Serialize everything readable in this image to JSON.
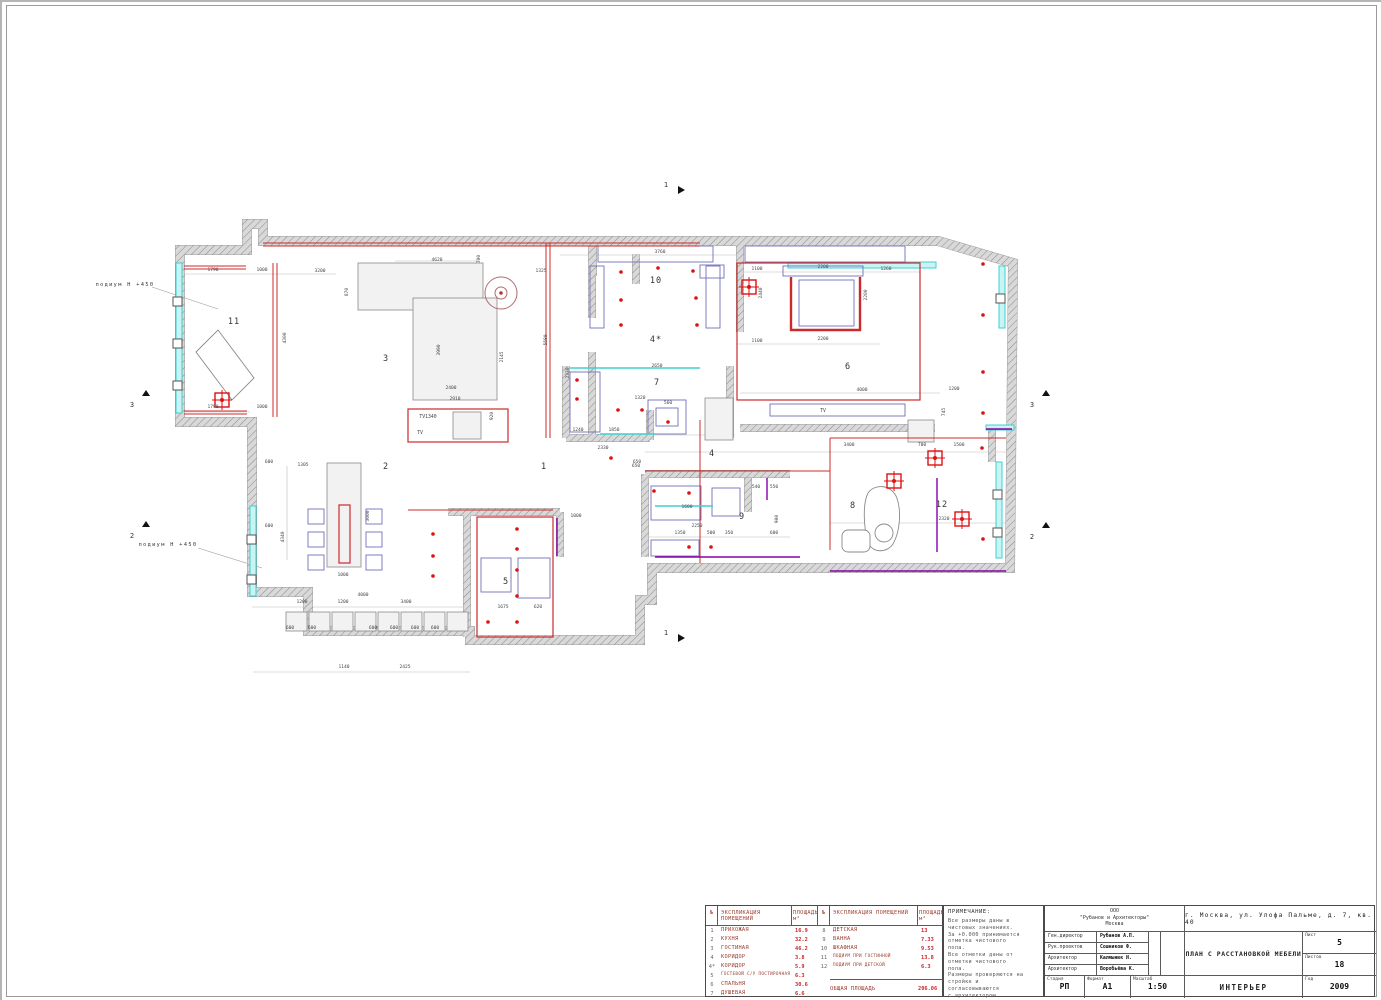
{
  "plan": {
    "wall_path": "M247,224 L263,224 L263,241 L938,241 L1013,263 L1010,568 L652,568 L652,600 L640,600 L640,640 L470,640 L470,631 L308,631 L308,592 L252,592 L252,422 L180,422 L180,250 L247,250 Z",
    "wallSeg": [
      [
        592,
        241,
        592,
        318
      ],
      [
        592,
        352,
        592,
        438
      ],
      [
        566,
        366,
        566,
        438
      ],
      [
        566,
        438,
        650,
        438
      ],
      [
        650,
        410,
        650,
        440
      ],
      [
        730,
        366,
        730,
        438
      ],
      [
        740,
        241,
        740,
        332
      ],
      [
        740,
        428,
        935,
        428
      ],
      [
        645,
        474,
        790,
        474
      ],
      [
        645,
        474,
        645,
        557
      ],
      [
        748,
        478,
        748,
        512
      ],
      [
        467,
        512,
        467,
        637
      ],
      [
        448,
        512,
        560,
        512
      ],
      [
        560,
        512,
        560,
        557
      ],
      [
        636,
        254,
        636,
        284
      ],
      [
        593,
        244,
        593,
        276
      ],
      [
        992,
        430,
        992,
        462
      ]
    ],
    "glaze": [
      [
        176,
        263,
        6,
        150
      ],
      [
        250,
        506,
        6,
        90
      ],
      [
        999,
        266,
        6,
        62
      ],
      [
        996,
        462,
        6,
        96
      ],
      [
        788,
        262,
        148,
        6
      ],
      [
        986,
        425,
        28,
        5
      ]
    ],
    "cols": [
      [
        173,
        297
      ],
      [
        173,
        339
      ],
      [
        173,
        381
      ],
      [
        247,
        535
      ],
      [
        247,
        575
      ],
      [
        996,
        294
      ],
      [
        993,
        490
      ],
      [
        993,
        528
      ]
    ],
    "graySeg": [
      [
        184,
        274,
        336,
        274
      ],
      [
        184,
        412,
        250,
        412
      ],
      [
        395,
        261,
        480,
        261
      ],
      [
        560,
        255,
        737,
        255
      ],
      [
        737,
        272,
        920,
        272
      ],
      [
        737,
        344,
        880,
        344
      ],
      [
        645,
        452,
        1006,
        452
      ],
      [
        830,
        523,
        1006,
        523
      ],
      [
        645,
        537,
        790,
        537
      ],
      [
        252,
        607,
        470,
        607
      ],
      [
        253,
        672,
        470,
        672
      ],
      [
        350,
        470,
        350,
        560
      ],
      [
        287,
        466,
        287,
        560
      ],
      [
        740,
        393,
        940,
        393
      ],
      [
        567,
        435,
        735,
        435
      ],
      [
        183,
        271,
        183,
        415
      ]
    ],
    "grayRect": [
      [
        358,
        263,
        125,
        47
      ],
      [
        413,
        298,
        84,
        102
      ],
      [
        327,
        463,
        34,
        104
      ],
      [
        453,
        412,
        28,
        27
      ],
      [
        908,
        420,
        26,
        22
      ],
      [
        705,
        398,
        28,
        42
      ],
      [
        286,
        612,
        21,
        19
      ],
      [
        309,
        612,
        21,
        19
      ],
      [
        332,
        612,
        21,
        19
      ],
      [
        355,
        612,
        21,
        19
      ],
      [
        378,
        612,
        21,
        19
      ],
      [
        401,
        612,
        21,
        19
      ],
      [
        424,
        612,
        21,
        19
      ],
      [
        447,
        612,
        21,
        19
      ]
    ],
    "paths": [
      "M196,352 L218,330 L254,378 L232,400 Z",
      "M868,493 C874,484 890,484 896,496 C902,510 900,532 893,544 C887,553 873,553 869,544 C864,532 862,505 868,493 Z",
      "M848,530 h16 a6,6 0 0 1 6,6 v10 a6,6 0 0 1 -6,6 h-16 a6,6 0 0 1 -6,-6 v-10 a6,6 0 0 1 6,-6 Z",
      "M875,533 a9,9 0 1 0 18,0 a9,9 0 1 0 -18,0 Z"
    ],
    "blueRect": [
      [
        598,
        246,
        115,
        16
      ],
      [
        590,
        266,
        14,
        62
      ],
      [
        706,
        266,
        14,
        62
      ],
      [
        745,
        246,
        160,
        16
      ],
      [
        783,
        266,
        80,
        10
      ],
      [
        700,
        265,
        24,
        13
      ],
      [
        770,
        404,
        135,
        12
      ],
      [
        308,
        509,
        16,
        15
      ],
      [
        308,
        532,
        16,
        15
      ],
      [
        308,
        555,
        16,
        15
      ],
      [
        366,
        509,
        16,
        15
      ],
      [
        366,
        532,
        16,
        15
      ],
      [
        366,
        555,
        16,
        15
      ],
      [
        651,
        486,
        50,
        34
      ],
      [
        712,
        488,
        28,
        28
      ],
      [
        651,
        540,
        48,
        16
      ],
      [
        570,
        372,
        30,
        60
      ],
      [
        648,
        400,
        38,
        34
      ],
      [
        656,
        408,
        22,
        18
      ],
      [
        481,
        558,
        30,
        34
      ],
      [
        518,
        558,
        32,
        40
      ],
      [
        799,
        280,
        55,
        46
      ]
    ],
    "redRect": [
      [
        737,
        263,
        183,
        137
      ],
      [
        477,
        517,
        76,
        120
      ],
      [
        408,
        409,
        100,
        33
      ],
      [
        339,
        505,
        11,
        58
      ]
    ],
    "redSeg": [
      [
        263,
        243,
        700,
        243
      ],
      [
        263,
        246,
        700,
        246
      ],
      [
        184,
        266,
        246,
        266
      ],
      [
        184,
        269,
        246,
        269
      ],
      [
        184,
        411,
        247,
        411
      ],
      [
        184,
        414,
        247,
        414
      ],
      [
        273,
        263,
        273,
        417
      ],
      [
        277,
        263,
        277,
        417
      ],
      [
        546,
        243,
        546,
        438
      ],
      [
        550,
        243,
        550,
        438
      ],
      [
        700,
        420,
        700,
        563
      ],
      [
        645,
        471,
        830,
        471
      ],
      [
        830,
        438,
        830,
        550
      ],
      [
        830,
        438,
        1006,
        438
      ],
      [
        408,
        510,
        553,
        510
      ]
    ],
    "redSeg2": [
      [
        791,
        277,
        791,
        331
      ],
      [
        790,
        330,
        861,
        330
      ],
      [
        860,
        277,
        860,
        331
      ]
    ],
    "purpleSeg": [
      [
        655,
        557,
        800,
        557
      ],
      [
        830,
        571,
        1006,
        571
      ],
      [
        937,
        478,
        937,
        552
      ],
      [
        986,
        429,
        1012,
        429
      ],
      [
        557,
        518,
        557,
        556
      ],
      [
        767,
        478,
        767,
        500
      ]
    ],
    "cyanSeg": [
      [
        570,
        368,
        700,
        368
      ],
      [
        655,
        506,
        713,
        506
      ],
      [
        600,
        434,
        656,
        434
      ]
    ],
    "dots": [
      [
        621,
        272
      ],
      [
        658,
        268
      ],
      [
        693,
        271
      ],
      [
        621,
        300
      ],
      [
        696,
        298
      ],
      [
        621,
        325
      ],
      [
        697,
        325
      ],
      [
        983,
        264
      ],
      [
        983,
        315
      ],
      [
        983,
        372
      ],
      [
        983,
        413
      ],
      [
        982,
        448
      ],
      [
        983,
        539
      ],
      [
        517,
        529
      ],
      [
        517,
        549
      ],
      [
        517,
        570
      ],
      [
        517,
        596
      ],
      [
        488,
        622
      ],
      [
        517,
        622
      ],
      [
        433,
        534
      ],
      [
        433,
        556
      ],
      [
        433,
        576
      ],
      [
        654,
        491
      ],
      [
        689,
        493
      ],
      [
        689,
        547
      ],
      [
        711,
        547
      ],
      [
        577,
        380
      ],
      [
        577,
        399
      ],
      [
        618,
        410
      ],
      [
        642,
        410
      ],
      [
        668,
        422
      ],
      [
        611,
        458
      ]
    ],
    "crosses": [
      [
        222,
        400
      ],
      [
        749,
        287
      ],
      [
        894,
        481
      ],
      [
        935,
        458
      ],
      [
        962,
        519
      ]
    ],
    "circle": {
      "cx": 501,
      "cy": 293,
      "r": 16
    },
    "rooms": [
      {
        "t": "1",
        "x": 544,
        "y": 469
      },
      {
        "t": "2",
        "x": 386,
        "y": 469
      },
      {
        "t": "3",
        "x": 386,
        "y": 361
      },
      {
        "t": "4",
        "x": 712,
        "y": 456
      },
      {
        "t": "4*",
        "x": 656,
        "y": 342
      },
      {
        "t": "5",
        "x": 506,
        "y": 584
      },
      {
        "t": "6",
        "x": 848,
        "y": 369
      },
      {
        "t": "7",
        "x": 657,
        "y": 385
      },
      {
        "t": "8",
        "x": 853,
        "y": 508
      },
      {
        "t": "9",
        "x": 742,
        "y": 519
      },
      {
        "t": "10",
        "x": 656,
        "y": 283
      },
      {
        "t": "11",
        "x": 234,
        "y": 324
      },
      {
        "t": "12",
        "x": 942,
        "y": 507
      }
    ],
    "texts": [
      {
        "t": "TV1340",
        "x": 428,
        "y": 418
      },
      {
        "t": "TV",
        "x": 420,
        "y": 434
      },
      {
        "t": "TV",
        "x": 823,
        "y": 412
      }
    ],
    "dims": [
      [
        "1790",
        213,
        271
      ],
      [
        "1000",
        262,
        271
      ],
      [
        "3200",
        320,
        272
      ],
      [
        "4300",
        286,
        338,
        1
      ],
      [
        "1790",
        213,
        408
      ],
      [
        "1000",
        262,
        408
      ],
      [
        "4620",
        437,
        261
      ],
      [
        "700",
        480,
        259,
        1
      ],
      [
        "1325",
        541,
        272
      ],
      [
        "3760",
        660,
        253
      ],
      [
        "870",
        348,
        292,
        1
      ],
      [
        "3990",
        440,
        350,
        1
      ],
      [
        "2145",
        503,
        357,
        1
      ],
      [
        "2400",
        451,
        389
      ],
      [
        "2910",
        455,
        400
      ],
      [
        "920",
        493,
        416,
        1
      ],
      [
        "5580",
        547,
        340,
        1
      ],
      [
        "2330",
        569,
        373,
        1
      ],
      [
        "1240",
        578,
        431
      ],
      [
        "1850",
        614,
        431
      ],
      [
        "2330",
        603,
        449
      ],
      [
        "650",
        637,
        463
      ],
      [
        "1100",
        757,
        270
      ],
      [
        "2200",
        823,
        268
      ],
      [
        "1260",
        886,
        270
      ],
      [
        "2440",
        762,
        293,
        1
      ],
      [
        "2200",
        867,
        295,
        1
      ],
      [
        "1100",
        757,
        342
      ],
      [
        "2200",
        823,
        340
      ],
      [
        "4000",
        862,
        391
      ],
      [
        "1200",
        954,
        390
      ],
      [
        "3400",
        849,
        446
      ],
      [
        "700",
        922,
        446
      ],
      [
        "1500",
        959,
        446
      ],
      [
        "745",
        945,
        412,
        1
      ],
      [
        "600",
        269,
        463
      ],
      [
        "1305",
        303,
        466
      ],
      [
        "4340",
        284,
        537,
        1
      ],
      [
        "600",
        269,
        527
      ],
      [
        "3000",
        369,
        516,
        1
      ],
      [
        "1000",
        343,
        576
      ],
      [
        "4000",
        363,
        596
      ],
      [
        "1200",
        302,
        603
      ],
      [
        "1200",
        343,
        603
      ],
      [
        "3400",
        406,
        603
      ],
      [
        "600",
        290,
        629
      ],
      [
        "600",
        312,
        629
      ],
      [
        "600",
        373,
        629
      ],
      [
        "600",
        394,
        629
      ],
      [
        "600",
        415,
        629
      ],
      [
        "600",
        435,
        629
      ],
      [
        "1140",
        344,
        668
      ],
      [
        "2425",
        405,
        668
      ],
      [
        "1675",
        503,
        608
      ],
      [
        "620",
        538,
        608
      ],
      [
        "1000",
        576,
        517
      ],
      [
        "650",
        636,
        467
      ],
      [
        "1600",
        687,
        508
      ],
      [
        "2250",
        697,
        527
      ],
      [
        "1350",
        680,
        534
      ],
      [
        "500",
        711,
        534
      ],
      [
        "350",
        729,
        534
      ],
      [
        "600",
        774,
        534
      ],
      [
        "540",
        756,
        488
      ],
      [
        "550",
        774,
        488
      ],
      [
        "900",
        778,
        519,
        1
      ],
      [
        "2320",
        944,
        520
      ],
      [
        "2650",
        657,
        367
      ],
      [
        "1320",
        640,
        399
      ],
      [
        "560",
        668,
        404
      ]
    ],
    "markers": [
      {
        "t": "1",
        "x": 666,
        "y": 187,
        "tx": 681,
        "ty": 190,
        "d": "r"
      },
      {
        "t": "1",
        "x": 666,
        "y": 635,
        "tx": 681,
        "ty": 638,
        "d": "r"
      },
      {
        "t": "3",
        "x": 132,
        "y": 407,
        "tx": 146,
        "ty": 393,
        "d": "u"
      },
      {
        "t": "2",
        "x": 132,
        "y": 538,
        "tx": 146,
        "ty": 524,
        "d": "u"
      },
      {
        "t": "3",
        "x": 1032,
        "y": 407,
        "tx": 1046,
        "ty": 393,
        "d": "u"
      },
      {
        "t": "2",
        "x": 1032,
        "y": 539,
        "tx": 1046,
        "ty": 525,
        "d": "u"
      }
    ],
    "podium": [
      {
        "t": "подиум Н +450",
        "x": 97,
        "y": 286,
        "l": [
          152,
          287,
          218,
          309
        ]
      },
      {
        "t": "подиум Н +450",
        "x": 140,
        "y": 546,
        "l": [
          198,
          548,
          262,
          568
        ]
      }
    ],
    "colors": {
      "red": "#cc2a2a",
      "dot": "#dd1111",
      "cyan": "#3fd0d0",
      "blue": "#7070bb",
      "purple": "#8800aa",
      "wallEdge": "#9a9a9a",
      "dim": "#45464c"
    }
  },
  "note": {
    "title": "ПРИМЕЧАНИЕ:",
    "lines": [
      "Все размеры даны в",
      "чистовых значениях.",
      "За +0.000 принимается",
      "отметка чистового",
      "пола.",
      "Все отметки даны от",
      "отметки чистового",
      "пола.",
      "Размеры проверяются на",
      "стройке и",
      "согласовываются",
      "с архитектором."
    ]
  },
  "explication": {
    "h_num": "№",
    "h_name": "ЭКСПЛИКАЦИЯ ПОМЕЩЕНИЙ",
    "h_area": "ПЛОЩАДЬ, м²",
    "rows_left": [
      [
        "1",
        "ПРИХОЖАЯ",
        "16.9"
      ],
      [
        "2",
        "КУХНЯ",
        "32.2"
      ],
      [
        "3",
        "ГОСТИНАЯ",
        "46.2"
      ],
      [
        "4",
        "КОРИДОР",
        "3.8"
      ],
      [
        "4*",
        "КОРИДОР",
        "5.9"
      ],
      [
        "5",
        "ГОСТЕВОЙ С/У ПОСТИРОЧНАЯ",
        "6.3"
      ],
      [
        "6",
        "СПАЛЬНЯ",
        "30.6"
      ],
      [
        "7",
        "ДУШЕВАЯ",
        "6.6"
      ]
    ],
    "rows_right": [
      [
        "8",
        "ДЕТСКАЯ",
        "13"
      ],
      [
        "9",
        "ВАННА",
        "7.33"
      ],
      [
        "10",
        "ШКАФНАЯ",
        "9.53"
      ],
      [
        "11",
        "ПОДИУМ ПРИ ГОСТИННОЙ",
        "13.8"
      ],
      [
        "12",
        "ПОДИУМ ПРИ ДЕТСКОЙ",
        "6.3"
      ]
    ],
    "total_label": "ОБЩАЯ ПЛОЩАДЬ",
    "total_value": "206.06"
  },
  "titleblock": {
    "company": "ООО\n\"Рубанов и Архитекторы\"\nМосква",
    "address": "г. Москва, ул. Улофа Пальме, д. 7, кв. 40",
    "roles": [
      [
        "Ген.директор",
        "Рубанов А.П."
      ],
      [
        "Рук.проектов",
        "Сошников Ф."
      ],
      [
        "Архитектор",
        "Калмынюк И."
      ],
      [
        "Архитектор",
        "Воробьёва К."
      ]
    ],
    "doc_title": "ПЛАН С РАССТАНОВКОЙ МЕБЕЛИ",
    "stage_label": "Стадия",
    "stage_value": "РП",
    "format_label": "Формат",
    "format_value": "А1",
    "scale_label": "Масштаб",
    "scale_value": "1:50",
    "section_title": "ИНТЕРЬЕР",
    "sheet_label": "Лист",
    "sheet_value": "5",
    "sheets_label": "Листов",
    "sheets_value": "18",
    "year_label": "Год",
    "year_value": "2009"
  }
}
